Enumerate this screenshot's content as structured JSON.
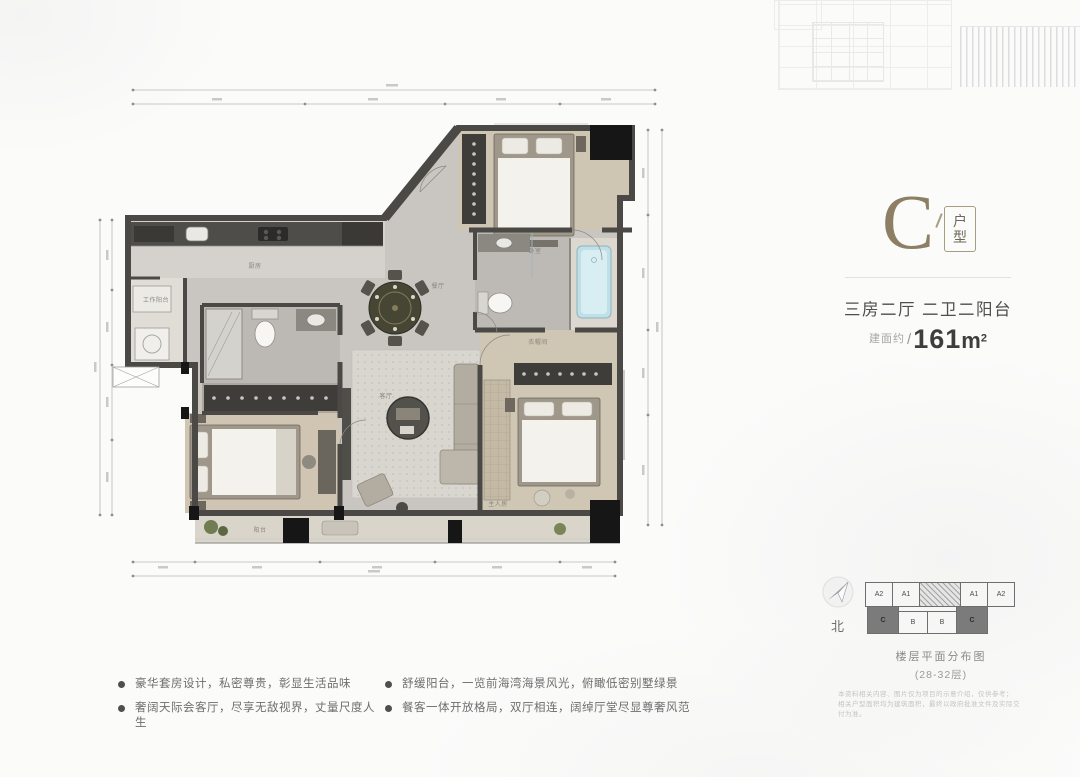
{
  "unit": {
    "letter": "C",
    "type_top": "户",
    "type_bottom": "型"
  },
  "specs": {
    "rooms": "三房二厅 二卫二阳台",
    "area_prefix": "建面约",
    "area_slash": "/",
    "area_value": "161",
    "area_unit": "m",
    "area_sup": "2"
  },
  "compass": {
    "north": "北"
  },
  "floor_diagram": {
    "top_units": [
      "A2",
      "A1",
      "A1",
      "A2"
    ],
    "bottom_units": [
      "C",
      "B",
      "B",
      "C"
    ],
    "caption": "楼层平面分布图",
    "floors": "(28-32层)"
  },
  "disclaimer": {
    "line1": "本资料相关内容、图片仅为项目的示意介绍，仅供参考；",
    "line2": "相关户型面积均为建筑面积，最终以政府批准文件及实际交付为准。"
  },
  "bullets": [
    "豪华套房设计，私密尊贵，彰显生活品味",
    "奢阔天际会客厅，尽享无敌视界，丈量尺度人生",
    "舒缓阳台，一览前海湾海景风光，俯瞰低密别墅绿景",
    "餐客一体开放格局，双厅相连，阔绰厅堂尽显尊奢风范"
  ],
  "plan_labels": {
    "work_balcony": "工作阳台",
    "kitchen": "厨房",
    "dining": "餐厅",
    "living": "客厅",
    "balcony": "阳台",
    "closet": "衣帽间",
    "master_bedroom": "主人房",
    "bedroom": "卧室"
  },
  "colors": {
    "accent_gold": "#8c7f63",
    "wall": "#4a4946",
    "highlight_unit": "#7b7b7b",
    "tub_blue": "#bfe0e8"
  }
}
